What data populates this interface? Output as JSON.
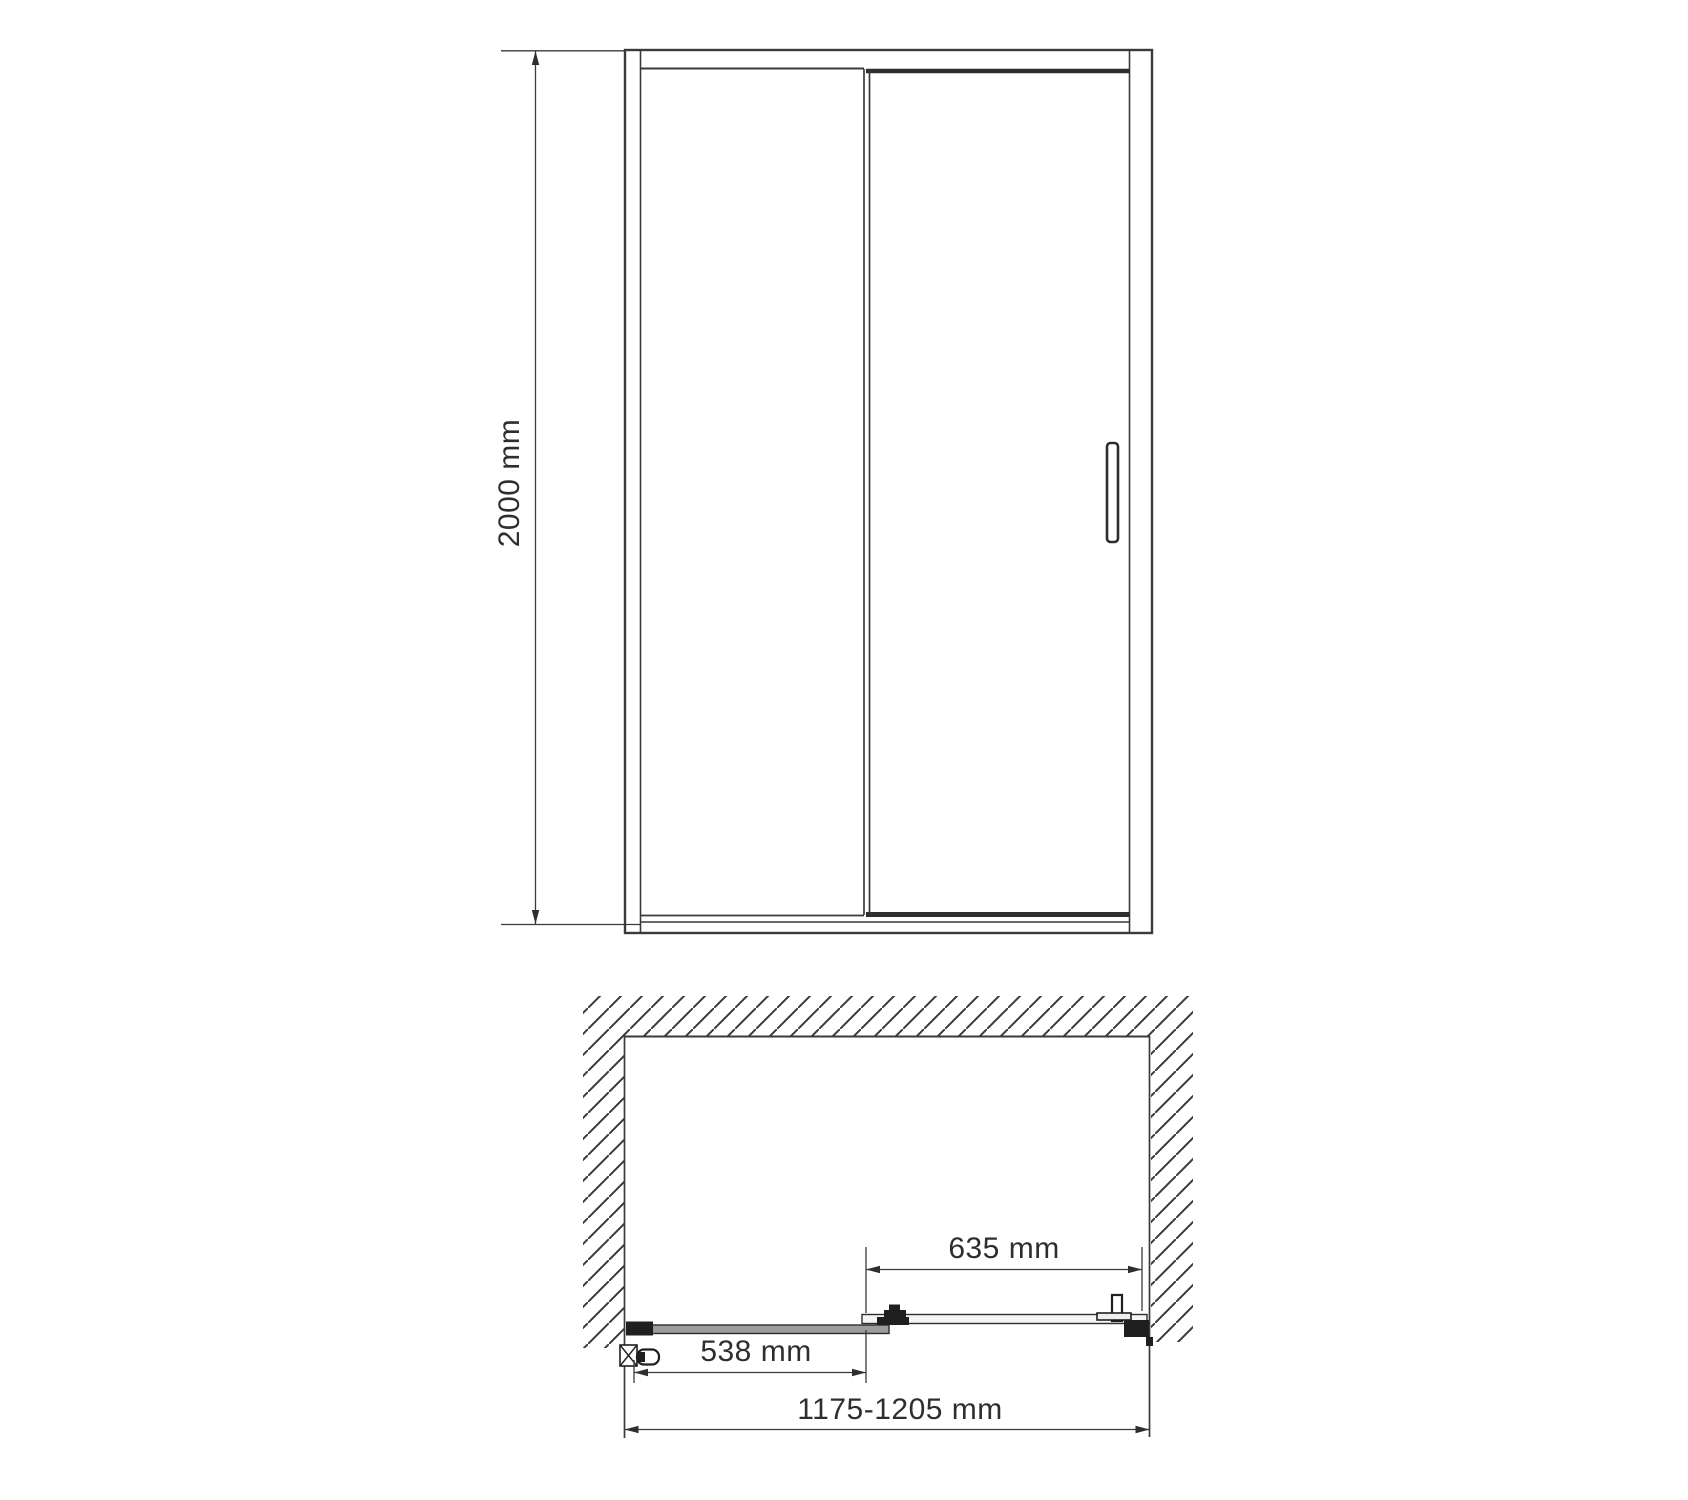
{
  "drawing": {
    "type": "shower-door-technical-drawing",
    "front_view": {
      "height_dimension": {
        "label": "2000 mm"
      }
    },
    "plan_view": {
      "sliding_door_dimension": {
        "label": "635 mm"
      },
      "fixed_panel_dimension": {
        "label": "538 mm"
      },
      "overall_width_dimension": {
        "label": "1175-1205 mm"
      }
    },
    "colors": {
      "line": "#3a3a3a",
      "panel_fill": "#9c9c9c",
      "hardware_fill": "#1f1f1f",
      "background": "#ffffff"
    }
  }
}
